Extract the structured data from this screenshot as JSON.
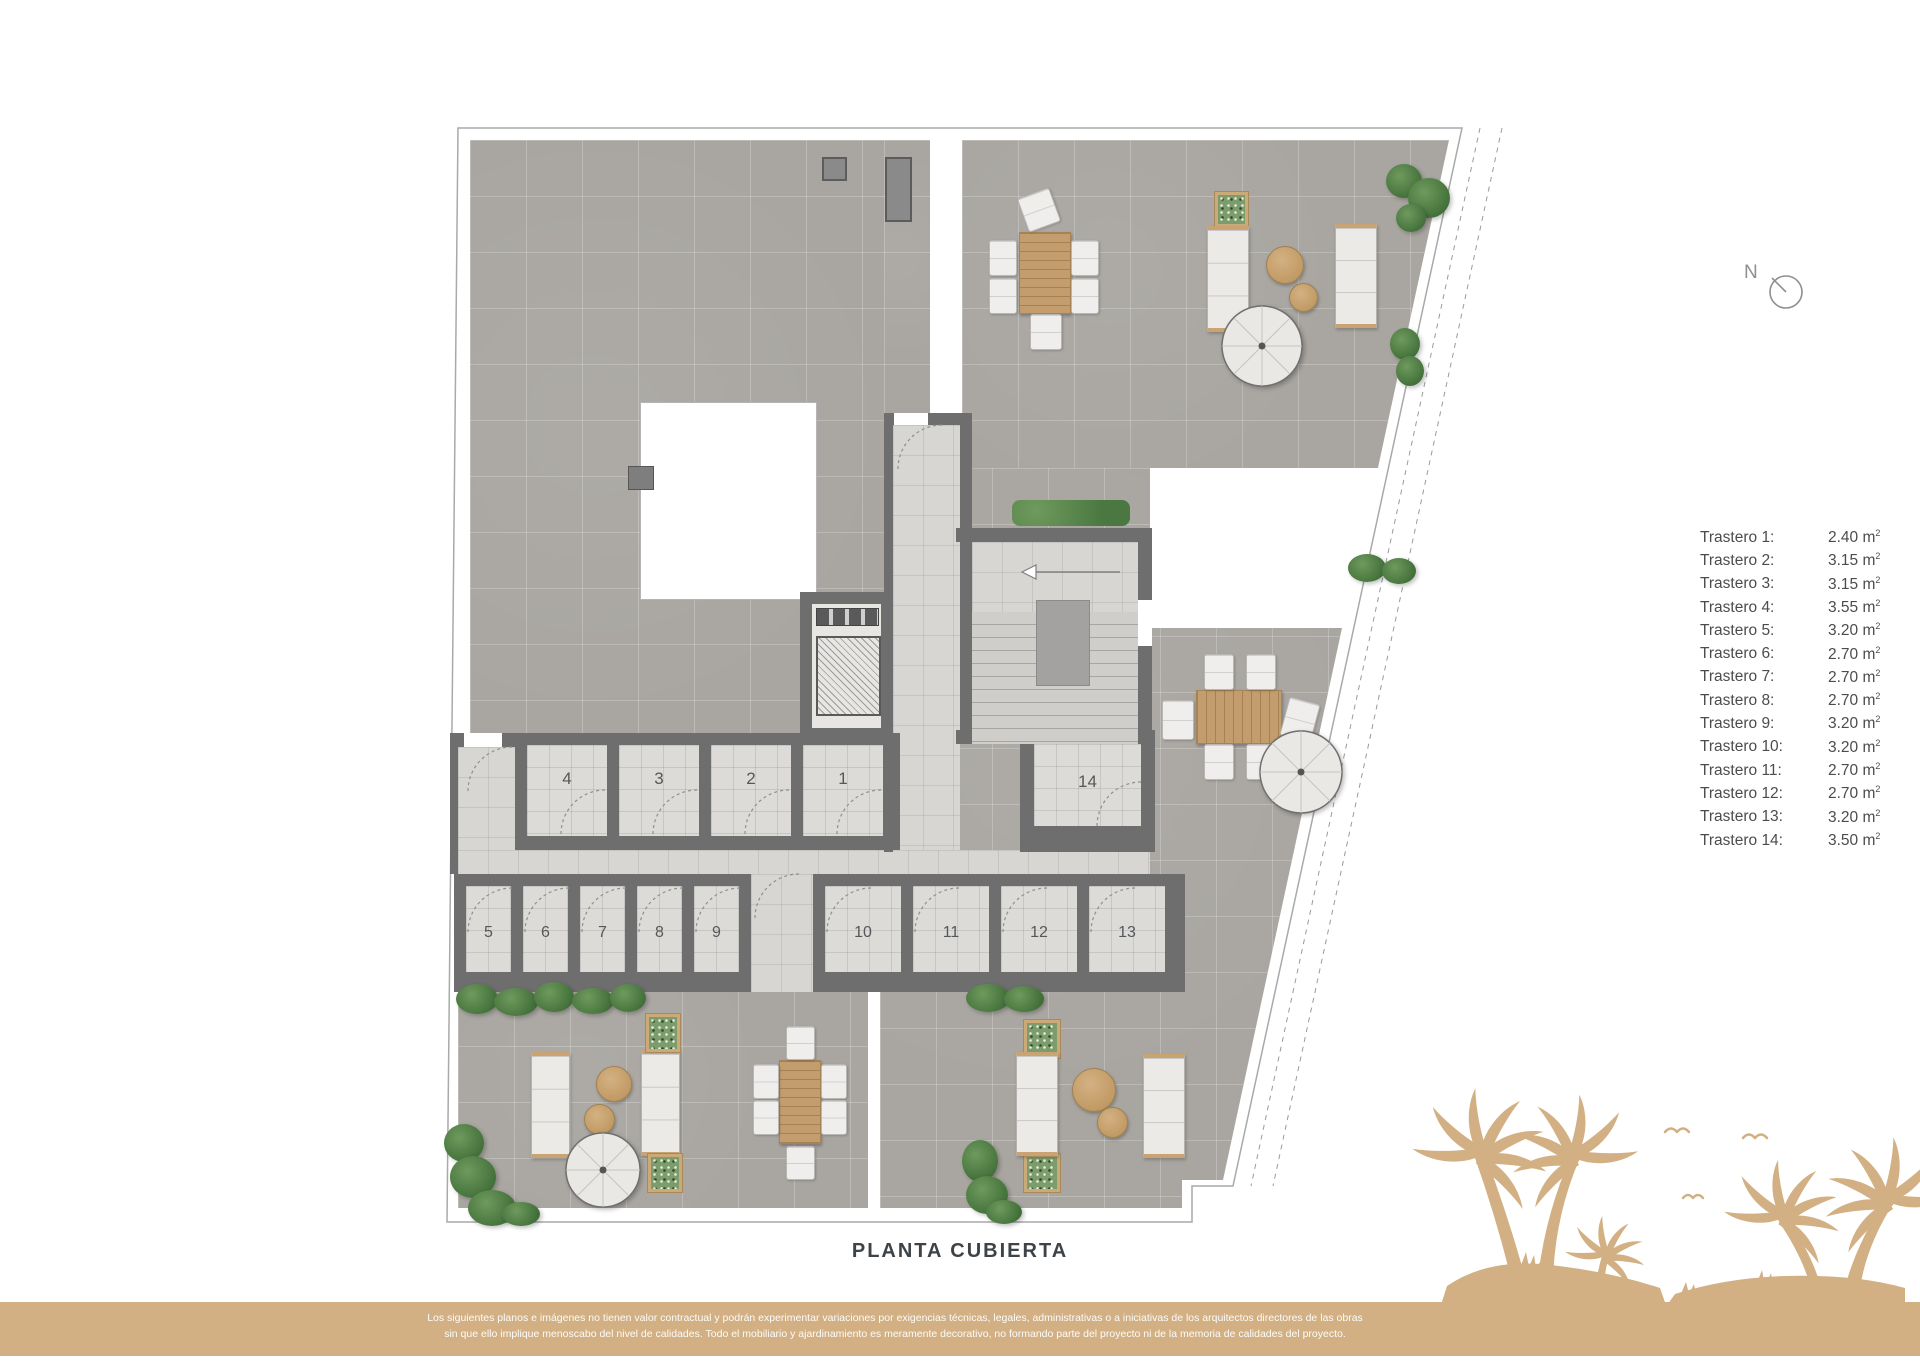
{
  "plan": {
    "title": "PLANTA CUBIERTA",
    "north_label": "N",
    "rooms": {
      "top_row": [
        "4",
        "3",
        "2",
        "1"
      ],
      "mid": "14",
      "bottom_left": [
        "5",
        "6",
        "7",
        "8",
        "9"
      ],
      "bottom_right": [
        "10",
        "11",
        "12",
        "13"
      ]
    }
  },
  "legend": {
    "unit_base": "m",
    "unit_sup": "2",
    "items": [
      {
        "label": "Trastero 1:",
        "area": "2.40"
      },
      {
        "label": "Trastero 2:",
        "area": "3.15"
      },
      {
        "label": "Trastero 3:",
        "area": "3.15"
      },
      {
        "label": "Trastero 4:",
        "area": "3.55"
      },
      {
        "label": "Trastero 5:",
        "area": "3.20"
      },
      {
        "label": "Trastero 6:",
        "area": "2.70"
      },
      {
        "label": "Trastero 7:",
        "area": "2.70"
      },
      {
        "label": "Trastero 8:",
        "area": "2.70"
      },
      {
        "label": "Trastero 9:",
        "area": "3.20"
      },
      {
        "label": "Trastero 10:",
        "area": "3.20"
      },
      {
        "label": "Trastero 11:",
        "area": "2.70"
      },
      {
        "label": "Trastero 12:",
        "area": "2.70"
      },
      {
        "label": "Trastero 13:",
        "area": "3.20"
      },
      {
        "label": "Trastero 14:",
        "area": "3.50"
      }
    ]
  },
  "footer": {
    "line1": "Los siguientes planos e imágenes no tienen valor contractual y podrán experimentar variaciones por exigencias técnicas, legales, administrativas o a iniciativas de los arquitectos directores de las obras",
    "line2": "sin que ello implique menoscabo del nivel de calidades. Todo el mobiliario y ajardinamiento es meramente decorativo, no formando parte del proyecto ni de la memoria de calidades del proyecto."
  },
  "colors": {
    "accent_tan": "#d2b083",
    "terrace_gray": "#a9a6a1",
    "room_tile": "#dcdbd8",
    "wall_gray": "#6e6e6f",
    "plant_green": "#4a7840"
  }
}
